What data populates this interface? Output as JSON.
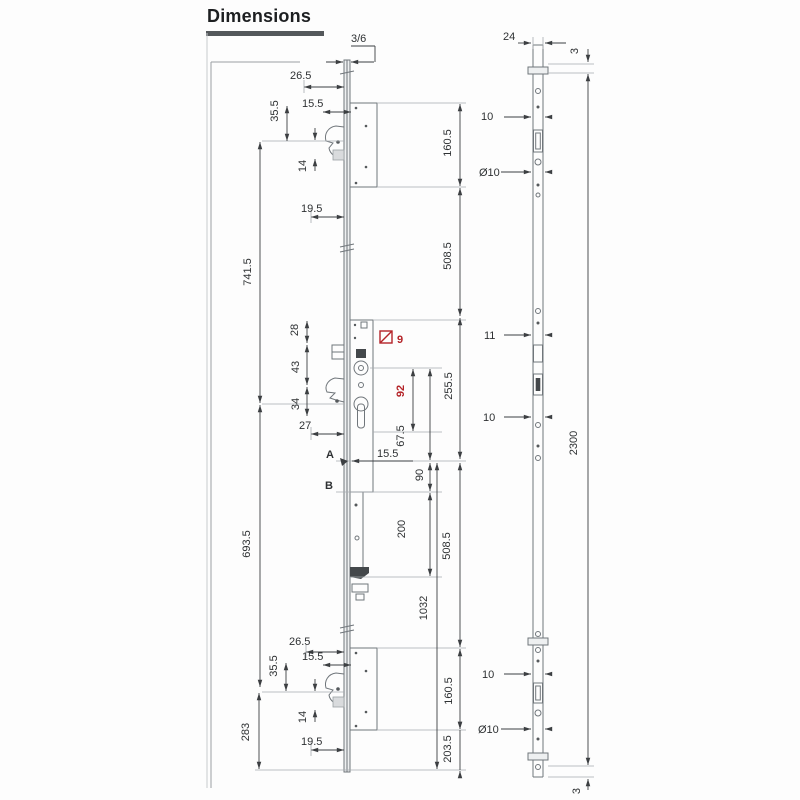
{
  "title": "Dimensions",
  "colors": {
    "drawing": "#70767b",
    "dimension": "#3c3f42",
    "accent_red": "#b42328"
  },
  "left_view": {
    "faceplate_thickness": "3/6",
    "upper": {
      "offset": "26.5",
      "backset": "15.5",
      "hook_height": "35.5",
      "pin": "14",
      "below": "19.5",
      "case_height": "160.5"
    },
    "spans": {
      "upper": "741.5",
      "upper_mid": "508.5",
      "centre": "255.5",
      "mid_lower": "508.5",
      "lower": "693.5",
      "overall": "1032",
      "bottom": "283"
    },
    "centre": {
      "d28": "28",
      "d43": "43",
      "d34": "34",
      "d27": "27",
      "spindle": "9",
      "pz": "92",
      "cyl": "67.5",
      "point_a": "A",
      "backset": "15.5",
      "point_b": "B",
      "d90": "90",
      "d200": "200"
    },
    "lower": {
      "offset": "26.5",
      "backset": "15.5",
      "hook_height": "35.5",
      "pin": "14",
      "below": "19.5",
      "case_height": "160.5",
      "end_height": "203.5"
    }
  },
  "right_view": {
    "width": "24",
    "top_end": "3",
    "upper_hole": "10",
    "upper_dia": "Ø10",
    "centre_hole": "11",
    "centre_hole2": "10",
    "total_length": "2300",
    "lower_hole": "10",
    "lower_dia": "Ø10",
    "bottom_end": "3"
  }
}
